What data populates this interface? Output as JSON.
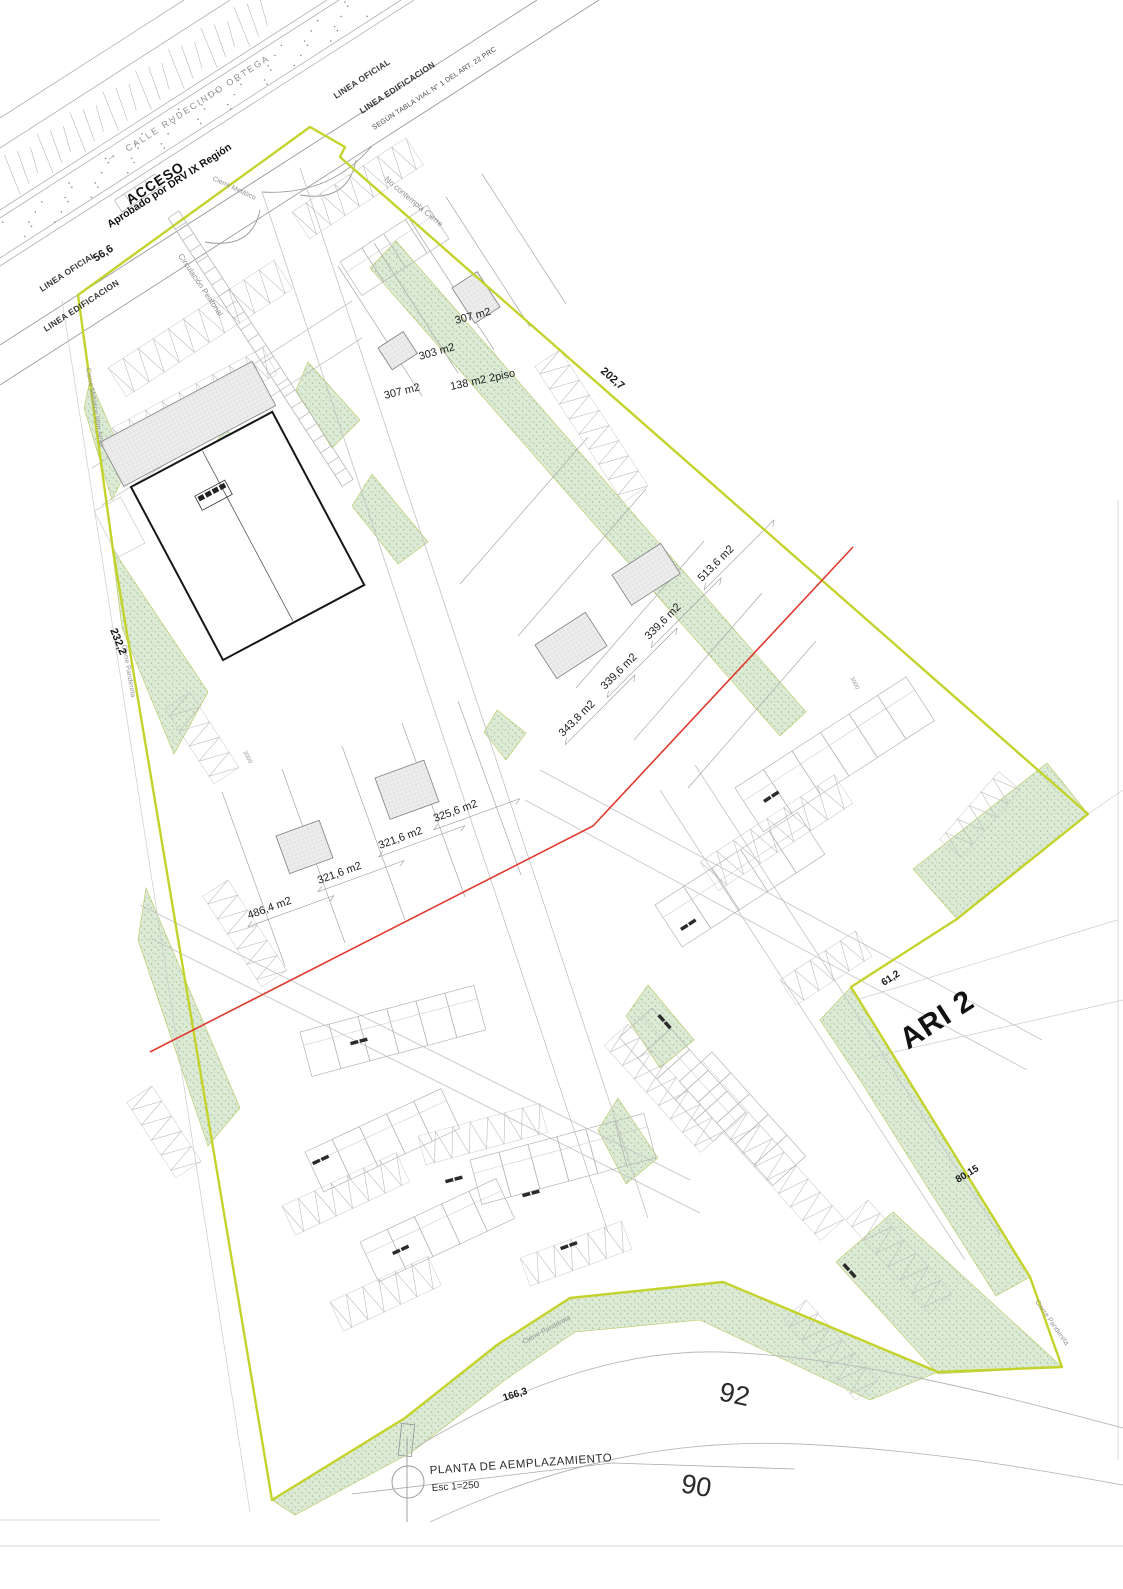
{
  "sheet": {
    "title": "PLANTA DE AEMPLAZAMIENTO",
    "scale": "Esc 1=250"
  },
  "street": {
    "name": "CALLE RUDECINDO ORTEGA",
    "direction_arrow": "→"
  },
  "access": {
    "title": "ACCESO",
    "approval": "Aprobado por DRV IX Región"
  },
  "reference_lines": {
    "linea_oficial": "LINEA OFICIAL",
    "linea_edificacion": "LINEA EDIFICACION",
    "segun_tabla_vial": "SEGÚN TABLA VIAL N° 1 DEL ART. 22 PRC",
    "no_contempla_cierre": "No contempla Cierre"
  },
  "fences": {
    "cierre_metalico": "Cierre Metálico",
    "cierre_metalico_left": "Cierre Metálico 90m Atras",
    "cierre_pandereta": "Cierre Pandereta",
    "circulacion_peatonal": "Circulación Peatonal"
  },
  "dimensions": {
    "north_west": "56,6",
    "north_east": "202,7",
    "west": "232,2",
    "east_upper": "61,2",
    "east_lower": "80,15",
    "south": "166,3",
    "road_width": "3000"
  },
  "zones": {
    "adjacent": "ARI 2"
  },
  "contour_labels": {
    "c92": "92",
    "c90": "90"
  },
  "lots": {
    "north": [
      "307 m2",
      "303 m2",
      "138 m2 2piso",
      "307 m2"
    ],
    "east": [
      "513,6 m2",
      "339,6 m2",
      "339,6 m2",
      "343,8 m2"
    ],
    "west": [
      "486,4 m2",
      "321,6 m2",
      "321,6 m2",
      "325,6 m2"
    ]
  },
  "colors": {
    "boundary": "#c3d32c",
    "vegetation": "#b7cfa8",
    "reference_red": "#e03a2e"
  }
}
